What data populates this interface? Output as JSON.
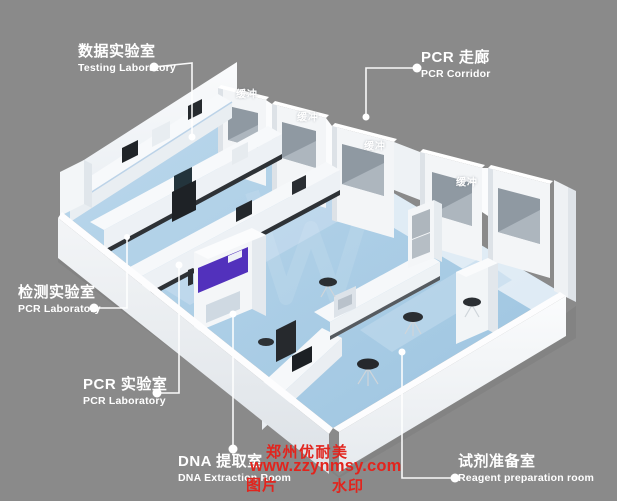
{
  "scene": {
    "description": "3D isometric rendering of a PCR laboratory suite with buffer rooms along a corridor"
  },
  "colors": {
    "background": "#8a8a8a",
    "floor_blue": "#aacfe8",
    "cabinet_purple": "#5231bc",
    "watermark_red": "#e2241d",
    "label_white": "#ffffff"
  },
  "callouts": [
    {
      "id": "testing-laboratory",
      "zh": "数据实验室",
      "en": "Testing Laboratory"
    },
    {
      "id": "pcr-corridor",
      "zh": "PCR 走廊",
      "en": "PCR Corridor"
    },
    {
      "id": "pcr-laboratory-left",
      "zh": "检测实验室",
      "en": "PCR Laboratory"
    },
    {
      "id": "pcr-laboratory-bottom",
      "zh": "PCR 实验室",
      "en": "PCR Laboratory"
    },
    {
      "id": "dna-extraction-room",
      "zh": "DNA 提取室",
      "en": "DNA Extraction Room"
    },
    {
      "id": "reagent-preparation-room",
      "zh": "试剂准备室",
      "en": "Reagent preparation room"
    }
  ],
  "room_tags": {
    "buffer": [
      "缓冲",
      "缓冲",
      "缓冲",
      "缓冲"
    ]
  },
  "watermark": {
    "brand": "郑州优耐美",
    "url": "www.zzynmsy.com",
    "left": "图片",
    "right": "水印"
  }
}
